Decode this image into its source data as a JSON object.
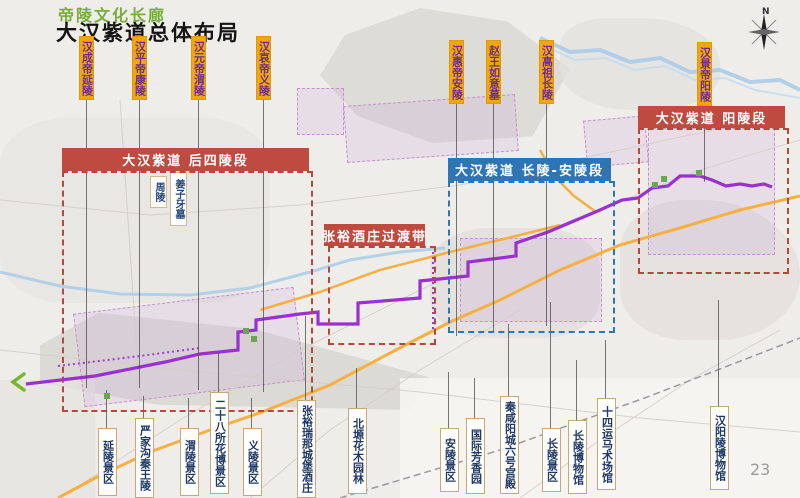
{
  "header": {
    "supertitle": "帝陵文化长廊",
    "title": "大汉紫道总体布局"
  },
  "compass_label": "N",
  "page_number": "23",
  "tomb_labels": [
    {
      "label": "汉成帝延陵",
      "x": 79,
      "top": 36,
      "h": 64,
      "line_to": 388
    },
    {
      "label": "汉平帝康陵",
      "x": 132,
      "top": 36,
      "h": 64,
      "line_to": 388
    },
    {
      "label": "汉元帝渭陵",
      "x": 191,
      "top": 36,
      "h": 64,
      "line_to": 390
    },
    {
      "label": "汉哀帝义陵",
      "x": 256,
      "top": 36,
      "h": 64,
      "line_to": 392
    },
    {
      "label": "汉惠帝安陵",
      "x": 449,
      "top": 40,
      "h": 64,
      "line_to": 336
    },
    {
      "label": "赵王如意墓",
      "x": 486,
      "top": 40,
      "h": 64,
      "line_to": 332
    },
    {
      "label": "汉高祖长陵",
      "x": 539,
      "top": 40,
      "h": 64,
      "line_to": 326
    },
    {
      "label": "汉景帝阳陵",
      "x": 697,
      "top": 42,
      "h": 64,
      "line_to": 182
    }
  ],
  "section_boxes": [
    {
      "title": "大汉紫道 后四陵段",
      "color": "red",
      "banner": [
        62,
        148,
        247,
        23
      ],
      "box": [
        62,
        171,
        247,
        237
      ]
    },
    {
      "title": "张裕酒庄过渡带",
      "color": "red",
      "banner": [
        324,
        224,
        101,
        22
      ],
      "box": [
        328,
        246,
        104,
        95
      ]
    },
    {
      "title": "大汉紫道 长陵-安陵段",
      "color": "blue",
      "banner": [
        448,
        158,
        163,
        23
      ],
      "box": [
        448,
        181,
        163,
        148
      ]
    },
    {
      "title": "大汉紫道 阳陵段",
      "color": "red",
      "banner": [
        638,
        106,
        147,
        22
      ],
      "box": [
        638,
        128,
        147,
        142
      ]
    }
  ],
  "map_point_labels": [
    {
      "label": "周陵",
      "x": 150,
      "top": 176,
      "h": 30
    },
    {
      "label": "姜子牙墓",
      "x": 170,
      "top": 172,
      "h": 52
    }
  ],
  "site_labels": [
    {
      "label": "延陵景区",
      "x": 98,
      "top": 428,
      "h": 66,
      "line_top": 390
    },
    {
      "label": "严家沟秦王陵",
      "x": 135,
      "top": 418,
      "h": 78,
      "line_top": 396
    },
    {
      "label": "渭陵景区",
      "x": 180,
      "top": 428,
      "h": 66,
      "line_top": 398
    },
    {
      "label": "二十八所花博景区",
      "x": 210,
      "top": 392,
      "h": 100,
      "line_top": 352
    },
    {
      "label": "义陵景区",
      "x": 243,
      "top": 428,
      "h": 66,
      "line_top": 398
    },
    {
      "label": "张裕瑞那城堡酒庄",
      "x": 297,
      "top": 400,
      "h": 96,
      "line_top": 316
    },
    {
      "label": "北塬花木园林",
      "x": 348,
      "top": 408,
      "h": 84,
      "line_top": 368
    },
    {
      "label": "安陵景区",
      "x": 440,
      "top": 428,
      "h": 62,
      "line_top": 372
    },
    {
      "label": "国际芳香园",
      "x": 466,
      "top": 418,
      "h": 74,
      "line_top": 378
    },
    {
      "label": "秦咸阳城六号宫殿",
      "x": 500,
      "top": 396,
      "h": 96,
      "line_top": 324
    },
    {
      "label": "长陵景区",
      "x": 542,
      "top": 428,
      "h": 62,
      "line_top": 302
    },
    {
      "label": "长陵博物馆",
      "x": 568,
      "top": 420,
      "h": 72,
      "line_top": 360
    },
    {
      "label": "十四运马术场馆",
      "x": 597,
      "top": 398,
      "h": 90,
      "line_top": 340
    },
    {
      "label": "汉阳陵博物馆",
      "x": 710,
      "top": 406,
      "h": 82,
      "line_top": 300
    }
  ]
}
